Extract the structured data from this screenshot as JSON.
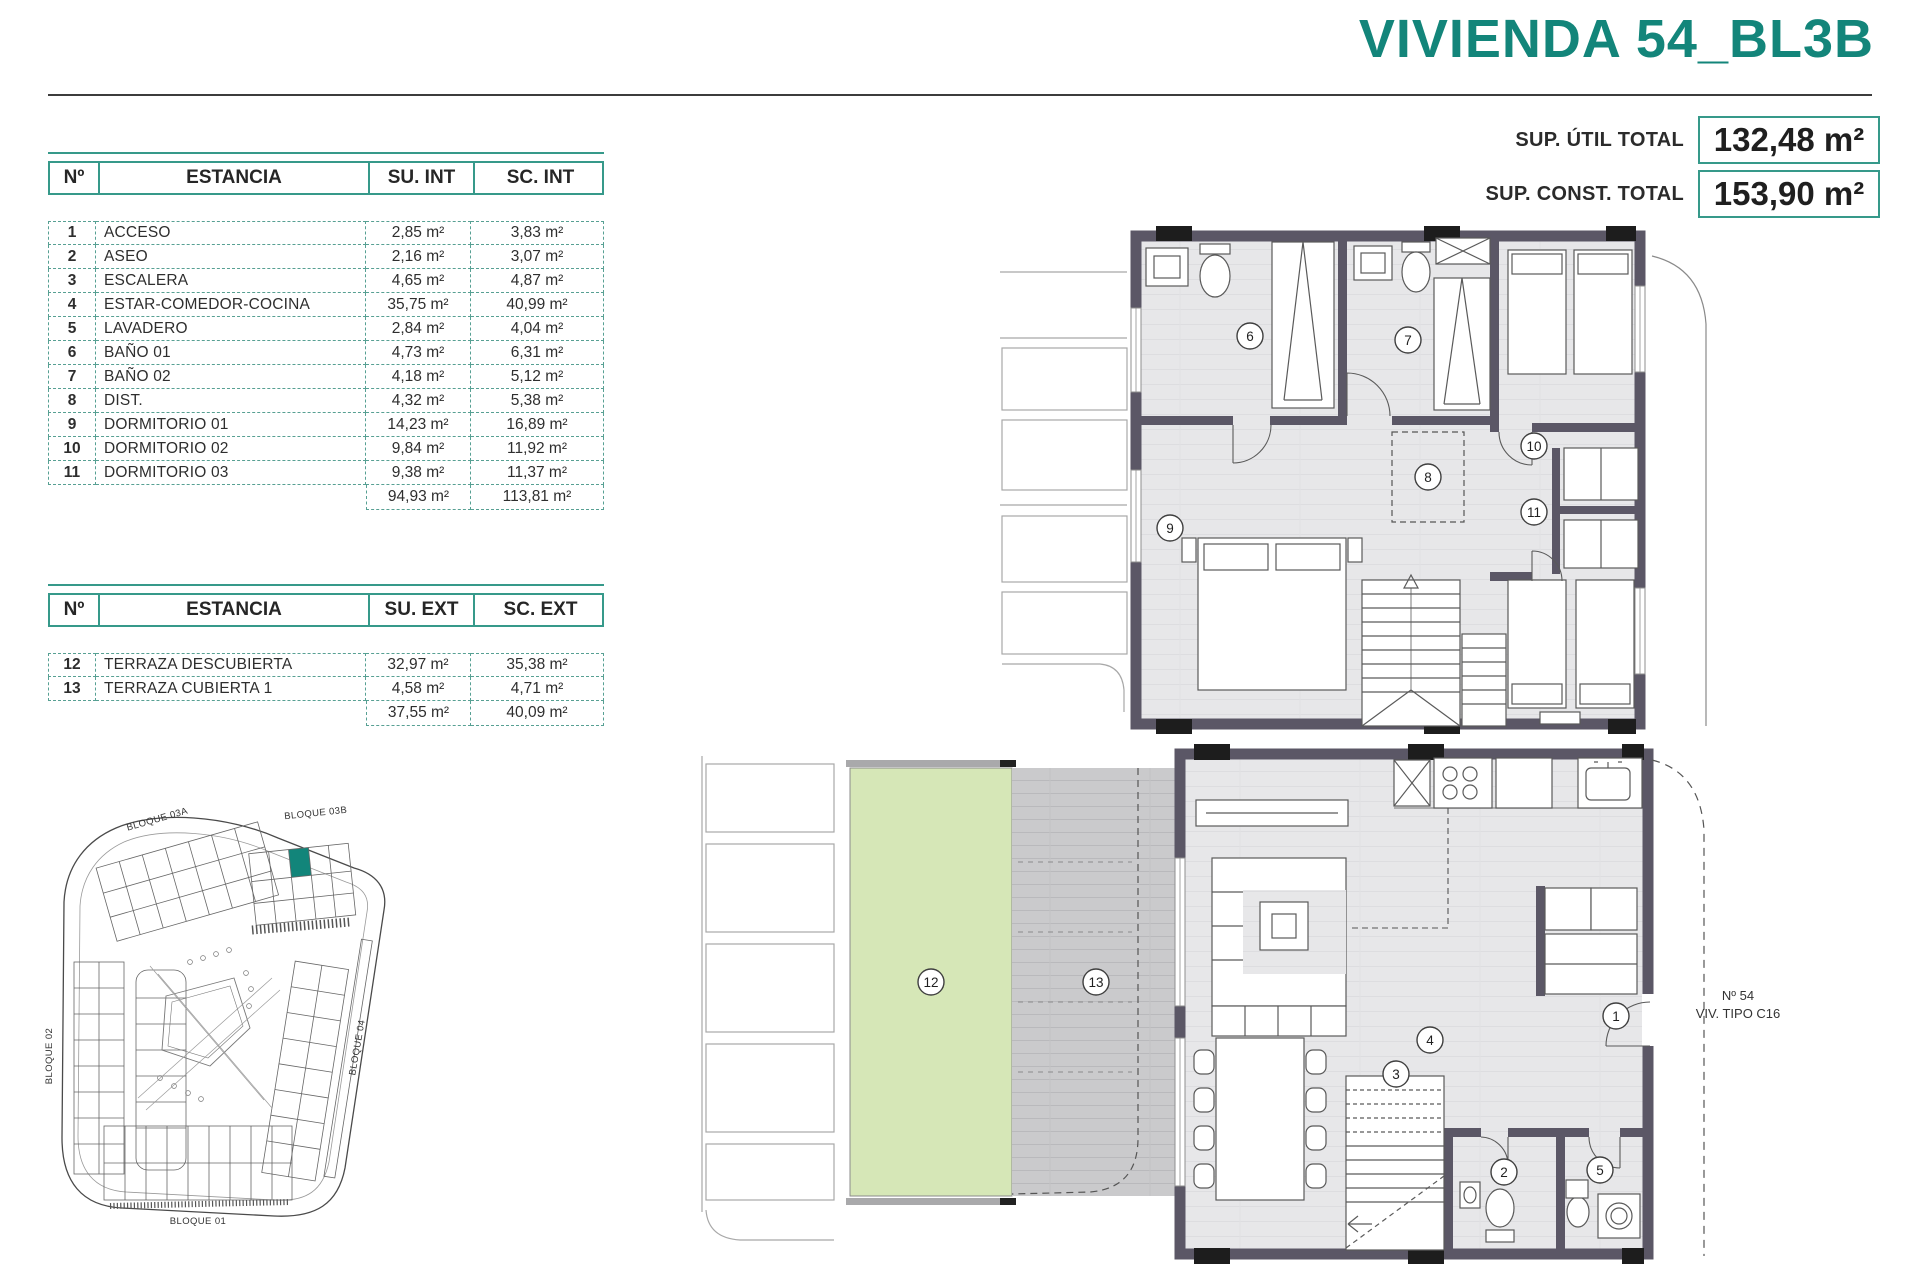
{
  "title": "VIVIENDA 54_BL3B",
  "summary": {
    "util_label": "SUP. ÚTIL TOTAL",
    "util_value": "132,48 m²",
    "const_label": "SUP. CONST. TOTAL",
    "const_value": "153,90 m²"
  },
  "interior_table": {
    "headers": {
      "num": "Nº",
      "room": "ESTANCIA",
      "su": "SU. INT",
      "sc": "SC. INT"
    },
    "rows": [
      {
        "num": "1",
        "room": "ACCESO",
        "su": "2,85 m²",
        "sc": "3,83 m²"
      },
      {
        "num": "2",
        "room": "ASEO",
        "su": "2,16 m²",
        "sc": "3,07 m²"
      },
      {
        "num": "3",
        "room": "ESCALERA",
        "su": "4,65 m²",
        "sc": "4,87 m²"
      },
      {
        "num": "4",
        "room": "ESTAR-COMEDOR-COCINA",
        "su": "35,75 m²",
        "sc": "40,99 m²"
      },
      {
        "num": "5",
        "room": "LAVADERO",
        "su": "2,84 m²",
        "sc": "4,04 m²"
      },
      {
        "num": "6",
        "room": "BAÑO 01",
        "su": "4,73 m²",
        "sc": "6,31 m²"
      },
      {
        "num": "7",
        "room": "BAÑO 02",
        "su": "4,18 m²",
        "sc": "5,12 m²"
      },
      {
        "num": "8",
        "room": "DIST.",
        "su": "4,32 m²",
        "sc": "5,38 m²"
      },
      {
        "num": "9",
        "room": "DORMITORIO 01",
        "su": "14,23 m²",
        "sc": "16,89 m²"
      },
      {
        "num": "10",
        "room": "DORMITORIO 02",
        "su": "9,84 m²",
        "sc": "11,92 m²"
      },
      {
        "num": "11",
        "room": "DORMITORIO 03",
        "su": "9,38 m²",
        "sc": "11,37 m²"
      }
    ],
    "total": {
      "su": "94,93 m²",
      "sc": "113,81 m²"
    }
  },
  "exterior_table": {
    "headers": {
      "num": "Nº",
      "room": "ESTANCIA",
      "su": "SU. EXT",
      "sc": "SC. EXT"
    },
    "rows": [
      {
        "num": "12",
        "room": "TERRAZA DESCUBIERTA",
        "su": "32,97 m²",
        "sc": "35,38 m²"
      },
      {
        "num": "13",
        "room": "TERRAZA CUBIERTA 1",
        "su": "4,58 m²",
        "sc": "4,71 m²"
      }
    ],
    "total": {
      "su": "37,55 m²",
      "sc": "40,09 m²"
    }
  },
  "site_plan": {
    "labels": {
      "b03a": "BLOQUE 03A",
      "b03b": "BLOQUE 03B",
      "b02": "BLOQUE 02",
      "b04": "BLOQUE 04",
      "b01": "BLOQUE 01"
    }
  },
  "plans": {
    "upper": {
      "rooms": [
        "6",
        "7",
        "8",
        "9",
        "10",
        "11"
      ]
    },
    "ground": {
      "rooms": [
        "1",
        "2",
        "3",
        "4",
        "5",
        "12",
        "13"
      ],
      "unit_no": "Nº 54",
      "unit_type": "VIV. TIPO C16"
    }
  },
  "colors": {
    "accent": "#13857a",
    "wall": "#5b5766",
    "terrace_green": "#d6e7b7",
    "deck_gray": "#cacacc"
  }
}
